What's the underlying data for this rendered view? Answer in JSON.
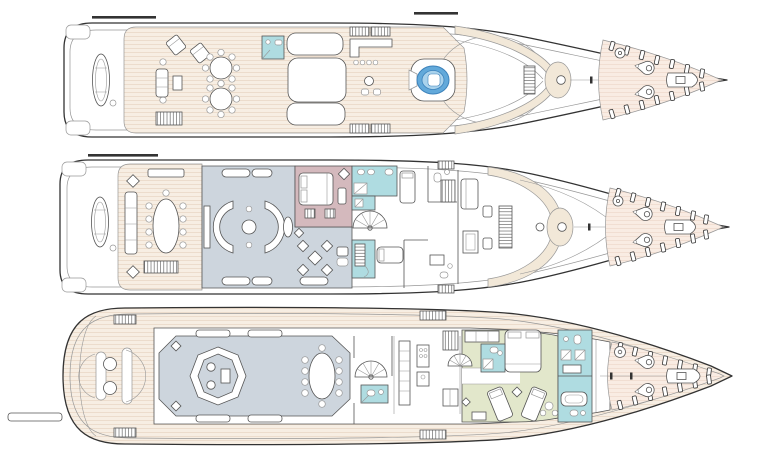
{
  "document": {
    "kind": "yacht-general-arrangement-plan",
    "decks_shown": 3,
    "orientation": "bow-right",
    "text_labels": []
  },
  "palette": {
    "paper": "#ffffff",
    "outline": "#333333",
    "line": "#555555",
    "line_light": "#979797",
    "deck_plank": "#f7eee3",
    "deck_plank_line": "#e9d8c6",
    "bow_plank": "#f9ece3",
    "bow_plank_line": "#efdacd",
    "cream": "#f2e8d8",
    "lounge": "#cdd5dd",
    "mauve": "#d4b9bd",
    "teal": "#afdce1",
    "green": "#e2e7cb",
    "jacuzzi": "#62a9da",
    "jacuzzi_light": "#a9d2ec",
    "jacuzzi_line": "#3c82bb"
  },
  "color_coding": {
    "teak_deck_areas": "#f7eee3",
    "foredeck_crew_areas": "#f9ece3",
    "salon_and_skylounge": "#cdd5dd",
    "owner_cabin": "#d4b9bd",
    "bathrooms_wet_areas": "#afdce1",
    "guest_cabins": "#e2e7cb",
    "jacuzzi_pool": "#62a9da",
    "superstructure_walkway_trim": "#f2e8d8"
  },
  "decks": [
    {
      "id": "sun-deck",
      "position": "top",
      "features": [
        "stowed-tender",
        "lounge-chairs",
        "two-round-dining-tables",
        "sofa-group",
        "day-head",
        "sun-pads",
        "bar-with-four-stools",
        "jacuzzi",
        "radar-arch",
        "foredeck-windlass",
        "anchor-winches",
        "rescue-tender"
      ]
    },
    {
      "id": "bridge-deck",
      "position": "middle",
      "features": [
        "stowed-tender",
        "aft-dining-oval-table",
        "skylounge-sofas",
        "owner-cabin-double-bed",
        "owner-bathroom-twin-sinks",
        "spiral-staircase",
        "games-table",
        "guest-cabins",
        "wheelhouse-console",
        "portuguese-bridge",
        "foredeck-windlass",
        "anchor-winches",
        "rescue-tender"
      ]
    },
    {
      "id": "main-deck",
      "position": "bottom",
      "features": [
        "passerelle",
        "swim-platform-seats",
        "main-salon-sofa-ring",
        "salon-dining-oval-table",
        "spiral-staircase",
        "day-head",
        "galley",
        "guest-cabin-double-bed",
        "guest-cabin-twin-beds",
        "guest-bathrooms",
        "crew-bow-area",
        "anchor-gear"
      ]
    }
  ]
}
